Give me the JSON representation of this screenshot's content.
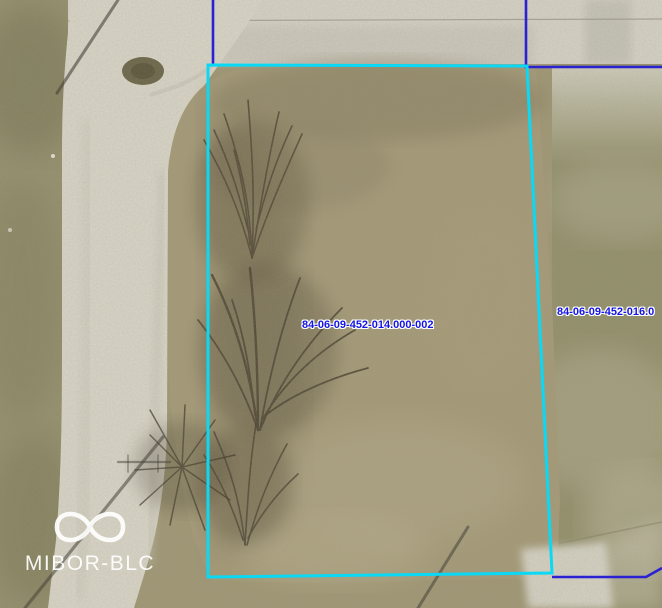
{
  "map": {
    "view": "aerial-parcel-view",
    "parcels": [
      {
        "id": "84-06-09-452-014.000-002",
        "selected": true
      },
      {
        "id": "84-06-09-452-016.0",
        "selected": false
      }
    ],
    "labels": {
      "selected_parcel": "84-06-09-452-014.000-002",
      "adjacent_parcel": "84-06-09-452-016.0"
    },
    "colors": {
      "selected_parcel_outline": "#0ad9f5",
      "parcel_line": "#2a21d2",
      "parcel_label_text": "#1414e6",
      "parcel_label_halo": "#ffffff"
    }
  },
  "watermark": {
    "logo_icon": "infinity-icon",
    "text": "MIBOR-BLC",
    "color": "#ffffff"
  }
}
